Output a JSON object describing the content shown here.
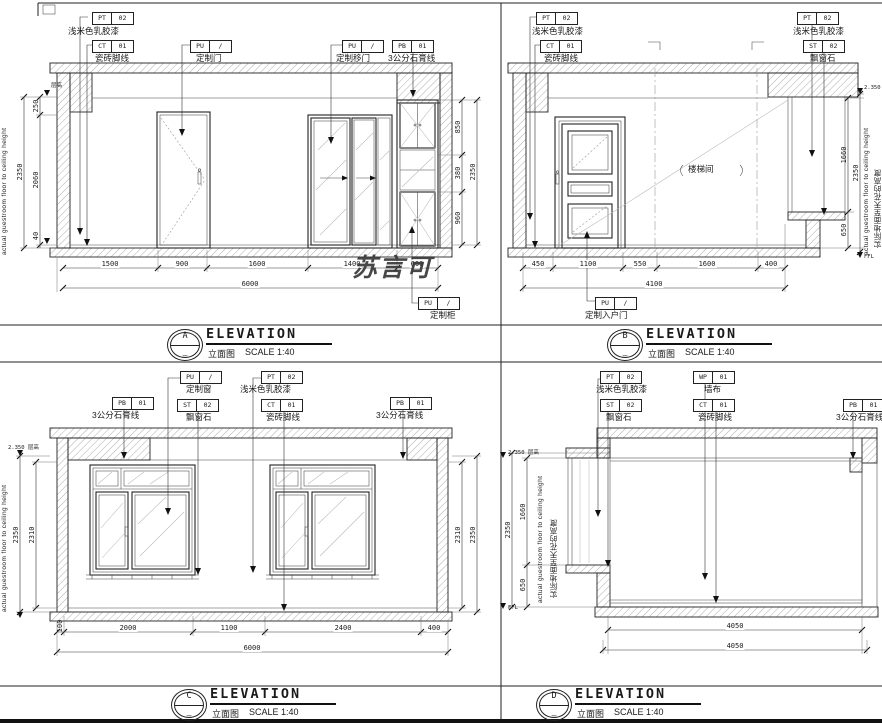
{
  "watermark": "苏言可",
  "panels": {
    "a": {
      "label": {
        "letter": "A",
        "sub": "—",
        "title": "ELEVATION",
        "subtitle": "立面图",
        "scale": "SCALE 1:40"
      },
      "tags": {
        "paint": {
          "code": "PT",
          "num": "02",
          "label": "浅米色乳胶漆"
        },
        "skirting": {
          "code": "CT",
          "num": "01",
          "label": "瓷砖脚线"
        },
        "door": {
          "code": "PU",
          "num": "/",
          "label": "定制门"
        },
        "sliding_door": {
          "code": "PU",
          "num": "/",
          "label": "定制移门"
        },
        "cornice": {
          "code": "PB",
          "num": "01",
          "label": "3公分石膏线"
        },
        "cabinet": {
          "code": "PU",
          "num": "/",
          "label": "定制柜"
        }
      },
      "dims": {
        "bottom": [
          "1500",
          "900",
          "1600",
          "1400",
          "600"
        ],
        "bottom_total": "6000",
        "left": [
          "250",
          "2060",
          "40"
        ],
        "left_total": "2350",
        "right": [
          "850",
          "380",
          "960"
        ],
        "right_total": "2350"
      },
      "side_text_en": "actual guestroom floor to ceiling height",
      "mark_top": "层高"
    },
    "b": {
      "label": {
        "letter": "B",
        "sub": "—",
        "title": "ELEVATION",
        "subtitle": "立面图",
        "scale": "SCALE 1:40"
      },
      "tags": {
        "paint_left": {
          "code": "PT",
          "num": "02",
          "label": "浅米色乳胶漆"
        },
        "skirting": {
          "code": "CT",
          "num": "01",
          "label": "瓷砖脚线"
        },
        "paint_right": {
          "code": "PT",
          "num": "02",
          "label": "浅米色乳胶漆"
        },
        "bay_stone": {
          "code": "ST",
          "num": "02",
          "label": "飘窗石"
        },
        "entry_door": {
          "code": "PU",
          "num": "/",
          "label": "定制入户门"
        }
      },
      "dims": {
        "bottom": [
          "450",
          "1100",
          "550",
          "1600",
          "400"
        ],
        "bottom_total": "4100",
        "right": [
          "1660",
          "650"
        ],
        "right_total": "2350"
      },
      "room_note": "楼梯间",
      "side_text_en": "actual guestroom floor to ceiling height",
      "side_text_cn": "实际地面至天花的高度",
      "mark_top": "2.350 层高",
      "mark_bottom": "FFL"
    },
    "c": {
      "label": {
        "letter": "C",
        "sub": "—",
        "title": "ELEVATION",
        "subtitle": "立面图",
        "scale": "SCALE 1:40"
      },
      "tags": {
        "cornice_left": {
          "code": "PB",
          "num": "01",
          "label": "3公分石膏线"
        },
        "window": {
          "code": "PU",
          "num": "/",
          "label": "定制窗"
        },
        "bay_stone": {
          "code": "ST",
          "num": "02",
          "label": "飘窗石"
        },
        "paint": {
          "code": "PT",
          "num": "02",
          "label": "浅米色乳胶漆"
        },
        "skirting": {
          "code": "CT",
          "num": "01",
          "label": "瓷砖脚线"
        },
        "cornice_right": {
          "code": "PB",
          "num": "01",
          "label": "3公分石膏线"
        }
      },
      "dims": {
        "bottom": [
          "100",
          "2000",
          "1100",
          "2400",
          "400"
        ],
        "bottom_total": "6000",
        "left_inner": "2310",
        "left_total": "2350",
        "right_inner": "2310",
        "right_total": "2350"
      },
      "side_text_en": "actual guestroom floor to ceiling height",
      "mark_top": "2.350 层高"
    },
    "d": {
      "label": {
        "letter": "D",
        "sub": "—",
        "title": "ELEVATION",
        "subtitle": "立面图",
        "scale": "SCALE 1:40"
      },
      "tags": {
        "paint": {
          "code": "PT",
          "num": "02",
          "label": "浅米色乳胶漆"
        },
        "bay_stone": {
          "code": "ST",
          "num": "02",
          "label": "飘窗石"
        },
        "wallpaper": {
          "code": "WP",
          "num": "01",
          "label": "墙布"
        },
        "skirting": {
          "code": "CT",
          "num": "01",
          "label": "瓷砖脚线"
        },
        "cornice": {
          "code": "PB",
          "num": "01",
          "label": "3公分石膏线"
        }
      },
      "dims": {
        "bottom_1": "4050",
        "bottom_2": "4050",
        "left": [
          "1660",
          "650"
        ],
        "left_total": "2350"
      },
      "side_text_en": "actual guestroom floor to ceiling height",
      "side_text_cn": "实际地面至天花的高度",
      "mark_top": "2.350 层高",
      "mark_bottom": "FFL"
    }
  }
}
